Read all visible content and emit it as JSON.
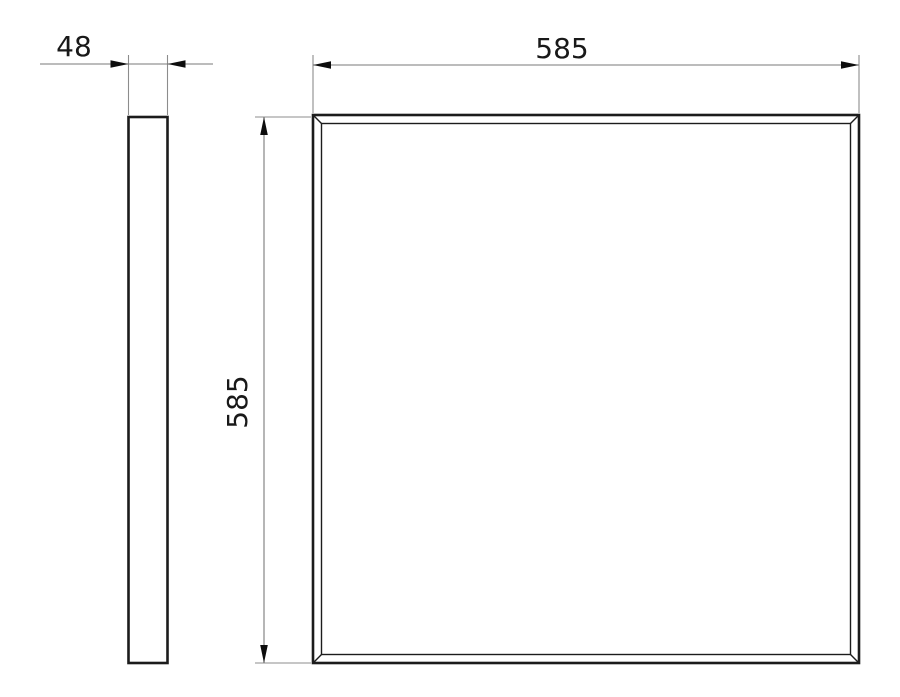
{
  "diagram": {
    "labels": {
      "side_thickness": "48",
      "front_width": "585",
      "front_height": "585"
    },
    "colors": {
      "background": "#ffffff",
      "outline": "#1c1c1c",
      "dimension_line": "#7a7a7a",
      "extension_line": "#8c8c8c",
      "arrow": "#0d0d0d",
      "text": "#191919"
    }
  }
}
